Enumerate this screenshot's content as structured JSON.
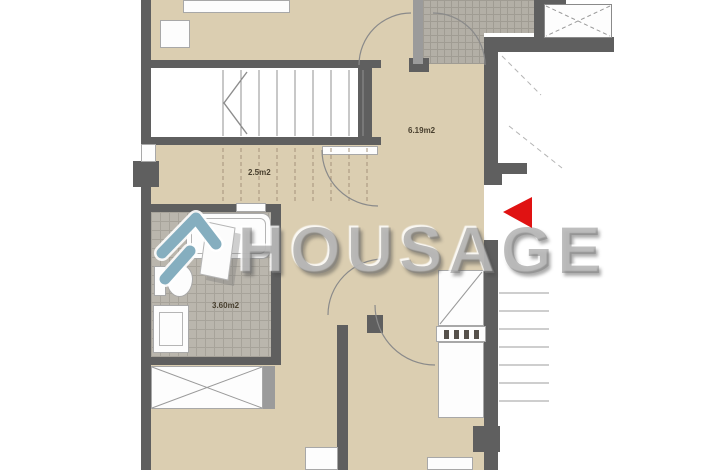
{
  "plan": {
    "type": "apartment-floor-plan",
    "rooms": [
      {
        "id": "hall-under-stairs",
        "area_label": "2.5m2"
      },
      {
        "id": "landing",
        "area_label": "6.19m2"
      },
      {
        "id": "bathroom",
        "area_label": "3.60m2"
      }
    ],
    "marker": {
      "shape": "triangle-left",
      "meaning": "entrance-direction"
    }
  },
  "watermark": {
    "text": "HOUSAGE"
  },
  "colors": {
    "floor_beige": "#dbceb1",
    "wall_gray": "#5f5f5f",
    "wall_light": "#9b9b9b",
    "tile_bg": "#bab6ad",
    "tile_line": "#a7a39a",
    "terrace_bg": "#b3afa6",
    "terrace_line": "#a09c93",
    "marker_red": "#e01212",
    "logo_teal": "#85aebf",
    "watermark_gray": "#7e7e7e"
  }
}
